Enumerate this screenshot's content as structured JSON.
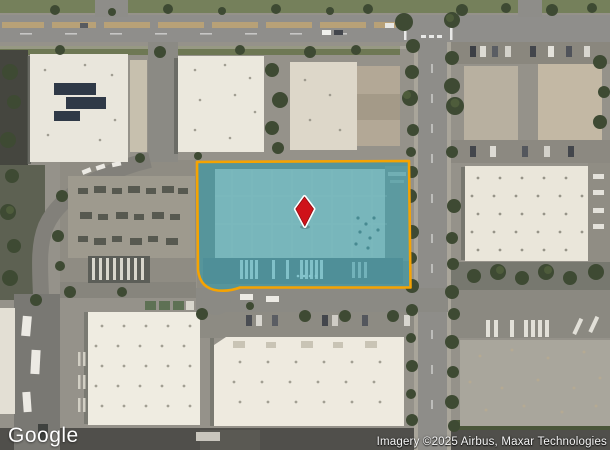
{
  "map": {
    "view_type": "satellite",
    "watermark": {
      "label": "Google"
    },
    "attribution": {
      "text": "Imagery ©2025 Airbus, Maxar Technologies"
    },
    "parcel_highlight": {
      "fill_color": "rgba(34,158,178,0.52)",
      "border_color": "#f5a302"
    },
    "marker": {
      "fill_color": "#cf1219",
      "edge_color": "#8e0d12",
      "outline_color": "#ffffff"
    }
  }
}
